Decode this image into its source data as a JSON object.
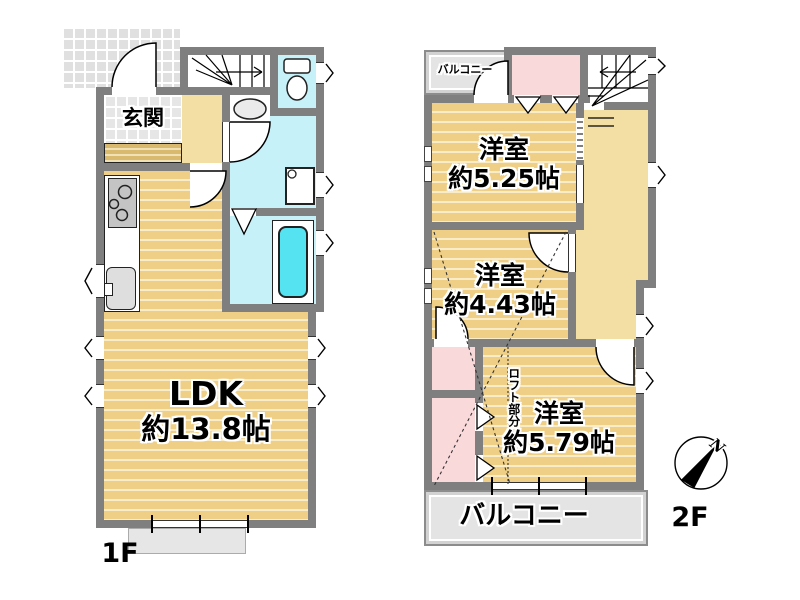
{
  "floor1": {
    "floor_label": "1F",
    "entrance_label": "玄関",
    "ldk_name": "LDK",
    "ldk_size": "約13.8帖"
  },
  "floor2": {
    "floor_label": "2F",
    "balcony_small_label": "バルコニー",
    "balcony_large_label": "バルコニー",
    "room_525_name": "洋室",
    "room_525_size": "約5.25帖",
    "room_443_name": "洋室",
    "room_443_size": "約4.43帖",
    "room_579_name": "洋室",
    "room_579_size": "約5.79帖",
    "loft_label": "ロフト部分"
  },
  "compass": {
    "north_label": "N"
  },
  "colors": {
    "wall_gray": "#7F7F7F",
    "room_tan": "#EFCF86",
    "hall_tan": "#F3DFA4",
    "sanitary_blue": "#C7F1F9",
    "bathtub_cyan": "#55E3F2",
    "closet_pink": "#FAD9DB",
    "balcony_gray": "#E4E4E4",
    "tile_gray": "#E6E6E6"
  }
}
